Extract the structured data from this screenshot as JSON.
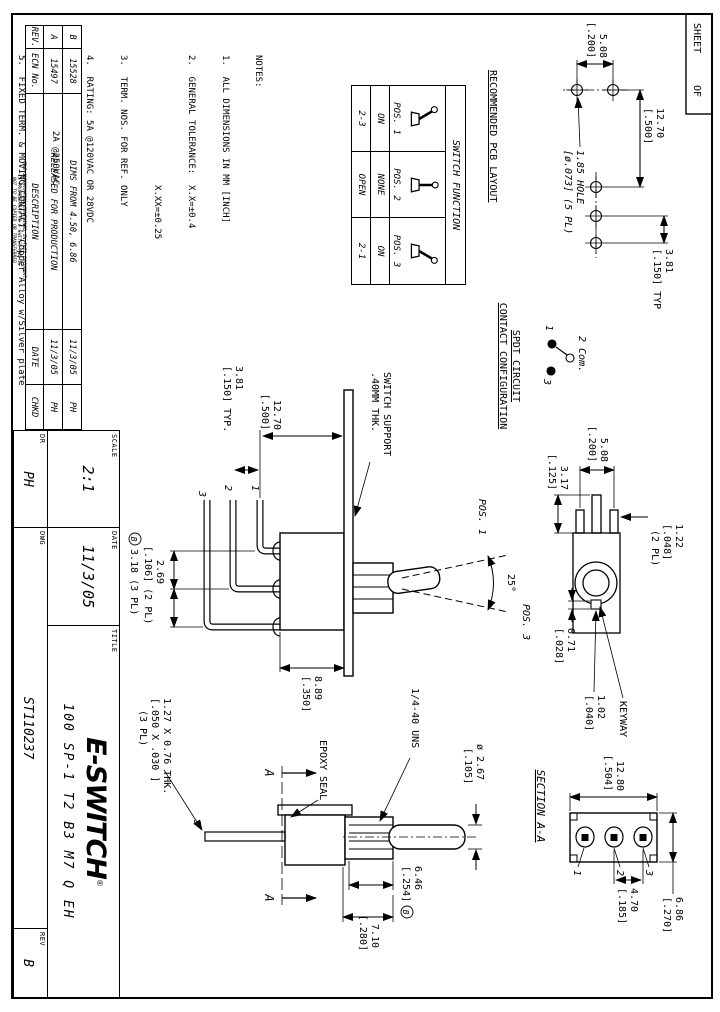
{
  "sheet_box": {
    "sheet": "SHEET",
    "of": "OF"
  },
  "colors": {
    "ink": "#000000",
    "paper": "#ffffff"
  },
  "pcb": {
    "title": "RECOMMENDED PCB LAYOUT",
    "dim_pitch_1": "5.08",
    "dim_pitch_2": "[.200]",
    "dim_span_1": "12.70",
    "dim_span_2": "[.500]",
    "dim_typ_1": "3.81",
    "dim_typ_2": "[.150] TYP",
    "hole_1": "1.85 HOLE",
    "hole_2": "[ø.073] (5 PL)"
  },
  "spdt": {
    "title_1": "SPDT CIRCUIT",
    "title_2": "CONTACT CONFIGURATION",
    "term_1": "1",
    "term_2": "2 Com.",
    "term_3": "3"
  },
  "keyway_view": {
    "dim_pitch_1": "5.08",
    "dim_pitch_2": "[.200]",
    "dim_317_1": "3.17",
    "dim_317_2": "[.125]",
    "dim_122_1": "1.22",
    "dim_122_2": "[.048]",
    "dim_122_3": "(2 PL)",
    "dim_071_1": "0.71",
    "dim_071_2": "[.028]",
    "dim_102_1": "1.02",
    "dim_102_2": "[.040]",
    "keyway": "KEYWAY"
  },
  "front_view": {
    "support_1": "SWITCH SUPPORT",
    "support_2": ".40MM THK.",
    "dim_span_1": "12.70",
    "dim_span_2": "[.500]",
    "dim_typ_1": "3.81",
    "dim_typ_2": "[.150] TYP.",
    "dim_height_1": "8.89",
    "dim_height_2": "[.350]",
    "dim_269_1": "2.69",
    "dim_269_2": "[.106] (2 PL)",
    "dim_318": "3.18 (3 PL)",
    "flag": "B",
    "pos_1": "POS. 1",
    "pos_3": "POS. 3",
    "angle": "25°",
    "pin_1": "1",
    "pin_2": "2",
    "pin_3": "3"
  },
  "side_view": {
    "thread": "1/4-40 UNS",
    "dia_1": "ø 2.67",
    "dia_2": "[.105]",
    "dim_646_1": "6.46",
    "dim_646_2": "[.254]",
    "flag": "B",
    "dim_710_1": "7.10",
    "dim_710_2": "[.280]",
    "epoxy": "EPOXY SEAL",
    "pin_dim_1": "1.27 X 0.76 THK.",
    "pin_dim_2": "[.050 X .030 ]",
    "pin_dim_3": "(3 PL)",
    "pin_3": "3",
    "section_a": "A"
  },
  "section_view": {
    "title": "SECTION A-A",
    "dim_w_1": "12.80",
    "dim_w_2": "[.504]",
    "dim_h_1": "6.86",
    "dim_h_2": "[.270]",
    "dim_s_1": "4.70",
    "dim_s_2": "[.185]",
    "term_1": "1",
    "term_2": "2",
    "term_3": "3"
  },
  "function_table": {
    "title": "SWITCH FUNCTION",
    "cols": [
      {
        "pos": "POS. 1",
        "on": "ON",
        "circuit": "2-3"
      },
      {
        "pos": "POS. 2",
        "on": "NONE",
        "circuit": "OPEN"
      },
      {
        "pos": "POS. 3",
        "on": "ON",
        "circuit": "2-1"
      }
    ]
  },
  "notes": {
    "heading": "NOTES:",
    "lines": [
      "1.  ALL DIMENSIONS IN MM [INCH]",
      "2.  GENERAL TOLERANCE:  X.X=±0.4",
      "                        X.XX=±0.25",
      "3.  TERM. NOS. FOR REF. ONLY",
      "4.  RATING: 5A @120VAC OR 28VDC",
      "              2A @250VAC",
      "5.  FIXED TERM. & MOVING CONTACT: Copper Alloy w/Silver plate",
      "6.  ELECTRICAL LIFE: 50,000 make-and-break",
      "        cycles at full load.",
      "7.  INSULATION RESISTANCE: 1,000M ohm min.",
      "8.  DIELECTRIC STRENGTH: 1000V RMS @sea level",
      "9.  OPERATING TEMP.: -30°C to 85°C",
      "10. 2002/95/EC (ROHS) COMPLIANT",
      "11. HARDWARE TO BE SUPPLIED BULK:",
      "        T100011-LOCK WASHER         QTY-1",
      "        T100015-LOCK RING           QTY-1",
      "        T100000-HEX NUT             QTY-2"
    ]
  },
  "rev_table": {
    "headers": {
      "rev": "REV.",
      "ecn": "ECN No.",
      "desc": "DESCRIPTION",
      "date": "DATE",
      "chkd": "CHKD"
    },
    "rows": [
      {
        "rev": "B",
        "ecn": "15528",
        "desc": "DIMS FROM 4.50, 6.86",
        "date": "11/3/05",
        "chkd": "PH"
      },
      {
        "rev": "A",
        "ecn": "15497",
        "desc": "RELEASED FOR PRODUCTION",
        "date": "11/3/05",
        "chkd": "PH"
      }
    ]
  },
  "proprietary": {
    "line1": "THE INFORMATION CONTAINED IN THIS DOCUMENT",
    "line2": "IS PROPRIETARY TO E-SWITCH AND IS",
    "line3": "NOT TO BE COPIED OR TRANSFERRED"
  },
  "title_block": {
    "title_label": "TITLE",
    "part_number": "100 SP-1 T2 B3 M7 Q EH",
    "logo": "E-SWITCH",
    "logo_reg": "®",
    "scale_label": "SCALE",
    "scale": "2:1",
    "date_label": "DATE",
    "date": "11/3/05",
    "dr_label": "DR",
    "dr": "PH",
    "dwg_label": "DWG",
    "dwg": "ST110237",
    "rev_label": "REV",
    "rev": "B"
  }
}
